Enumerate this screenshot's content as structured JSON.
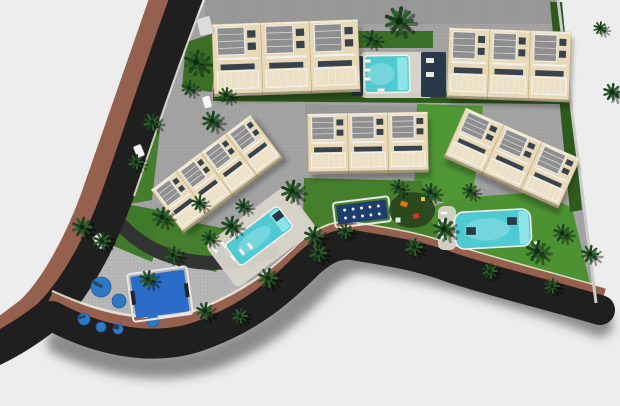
{
  "meta": {
    "title": "Aerial 3D masterplan render of a residential complex with townhouse blocks, pools, playgrounds and a curved perimeter road",
    "width": 620,
    "height": 406
  },
  "scene": {
    "colors": {
      "background": "#ededed",
      "pavement": "#a3a3a3",
      "pavement_dark": "#8c8c8c",
      "playground_pavement": "#b6b6b6",
      "road": "#1f1f1f",
      "driveway": "#2f2f2f",
      "sidewalk": "#96604f",
      "curb": "#e9e5d8",
      "road_shadow": "rgba(60,60,60,0.55)",
      "wall_cream": "#e8d9b9",
      "wall_edge": "#bfa97a",
      "roof_gray": "#8f8f8f",
      "roof_slat": "#dcdcdc",
      "parapet": "#f0ead8",
      "window_dark": "#39434d",
      "railing_white": "#f3f3f3",
      "water": "#4fc9d2",
      "water_light": "#9cebec",
      "deck_light": "#d8d5ca",
      "navy": "#2a3949",
      "court_navy": "#1e3c6e",
      "court_blue": "#2a6cc8",
      "pad_blue": "#2f79c2",
      "grass_bright": "#5fae3e",
      "palm_green": "#1c4220",
      "palm_green2": "#2a5c2a",
      "shadow": "rgba(0,0,0,0.3)",
      "boundary_wall": "#cbcbcb",
      "play_orange": "#e0761c",
      "play_red": "#cf3a2a",
      "play_yellow": "#e8c43c"
    },
    "site": {
      "path": "M205,0 L558,0 L596,303 C545,289 495,277 452,265 C415,254 385,247 358,241 C340,237 326,242 306,261 C278,288 248,312 208,328 C172,342 125,348 90,334 C70,326 56,310 60,292 C72,252 96,208 116,196 Z"
    },
    "paved": [
      {
        "name": "back-pavement-top",
        "path": "M205,0 L558,0 L558,24 L205,24 Z",
        "fill": "#8f8f8f",
        "opacity": 0.55
      },
      {
        "name": "back-pavement-mid",
        "path": "M305,104 L430,107 L430,117 L305,115 Z",
        "fill": "#909090",
        "opacity": 0.6
      },
      {
        "name": "terrace-right",
        "path": "M448,190 L552,186 L556,212 L452,216 Z",
        "fill": "#9e9e9e",
        "opacity": 1
      },
      {
        "name": "playground-pavement",
        "path": "M66,296 C80,250 96,234 118,231 L216,239 C238,243 250,257 248,276 C245,302 230,322 204,334 C175,347 126,346 97,337 C76,330 62,314 66,296 Z",
        "fill": "#b6b6b6",
        "opacity": 1
      }
    ],
    "grass": [
      {
        "name": "hedge-top-row",
        "path": "M213,89 L562,93 L562,104 L213,101 Z",
        "fill": "#2e5a1e"
      },
      {
        "name": "hedge-pool-garden",
        "path": "M357,31 L433,31 L433,48 L357,48 Z",
        "fill": "#3a7026"
      },
      {
        "name": "lawn-vertical-center",
        "path": "M417,104 L483,106 L472,206 L414,198 Z",
        "fill": "#4f9634"
      },
      {
        "name": "lawn-right",
        "path": "M428,208 L458,198 L540,192 L572,208 L594,300 L540,288 L468,266 L432,252 Z",
        "fill": "#4c9132"
      },
      {
        "name": "lawn-center",
        "path": "M304,178 L422,181 L436,236 L394,242 L336,246 L303,216 Z",
        "fill": "#457f2b"
      },
      {
        "name": "green-left-a",
        "path": "M128,121 L162,112 L152,200 L118,206 Z",
        "fill": "#447e2c"
      },
      {
        "name": "green-left-b",
        "path": "M116,202 L168,212 L152,262 L104,242 Z",
        "fill": "#3f7a2a"
      },
      {
        "name": "green-mid-left",
        "path": "M162,216 L232,230 L216,272 L148,256 Z",
        "fill": "#447e2c"
      },
      {
        "name": "green-top-left",
        "path": "M186,42 L218,32 L212,92 L182,88 Z",
        "fill": "#3c6f26"
      },
      {
        "name": "hedge-right-boundary",
        "path": "M550,2 L562,2 L582,210 L570,212 Z",
        "fill": "#2e5a1e"
      },
      {
        "name": "corner-grass-strip",
        "path": "M60,290 C64,310 76,322 94,331 L102,318 C86,310 75,299 72,287 Z",
        "fill": "#5fae3e"
      }
    ],
    "roads": {
      "sidewalk_upper": {
        "d": "M165,-14 C137,65 112,140 92,196 C76,240 52,285 28,308 C12,320 0,330 -14,338",
        "width": 22
      },
      "main_upper": {
        "d": "M190,-12 C162,62 138,138 118,194 C100,244 76,288 48,316 C30,330 12,342 -10,352",
        "width": 32
      },
      "curb_upper": {
        "d": "M206,-5 C180,60 155,135 134,196",
        "width": 2
      },
      "shadow_lower": {
        "d": "M60,342 C120,370 180,372 225,352 C270,332 298,306 326,276 C344,260 358,256 374,260 C408,266 438,272 470,282 C515,296 556,306 600,324",
        "width": 26
      },
      "curb_lower": {
        "d": "M52,291 C110,318 162,324 202,308 C246,290 274,268 302,241 C322,224 339,220 356,223 C393,229 420,233 452,245 C498,259 548,272 604,288",
        "width": 2.5
      },
      "sidewalk_lower": {
        "d": "M50,298 C108,326 160,332 202,316 C248,298 276,276 304,248 C324,231 340,227 356,230 C393,236 420,240 452,252 C498,266 548,279 604,295",
        "width": 13
      },
      "main_lower": {
        "d": "M52,316 C105,344 160,352 205,334 C252,316 280,292 308,264 C328,246 342,242 358,246 C395,252 420,256 452,268 C495,282 545,294 600,310",
        "width": 30
      },
      "driveway": {
        "d": "M106,206 C130,242 162,258 198,262 C226,265 250,260 272,251",
        "width": 14
      }
    },
    "boundary": {
      "x1": 558,
      "y1": 0,
      "x2": 596,
      "y2": 303
    },
    "buildings": [
      {
        "name": "building-block-1",
        "cx": 286,
        "cy": 58,
        "w": 146,
        "h": 72,
        "rot": -2,
        "units": 3
      },
      {
        "name": "building-block-2",
        "cx": 509,
        "cy": 65,
        "w": 122,
        "h": 70,
        "rot": 2,
        "units": 3
      },
      {
        "name": "building-block-3",
        "cx": 217,
        "cy": 174,
        "w": 124,
        "h": 54,
        "rot": -37,
        "units": 4
      },
      {
        "name": "building-block-4",
        "cx": 368,
        "cy": 143,
        "w": 120,
        "h": 60,
        "rot": -1,
        "units": 3
      },
      {
        "name": "building-block-5",
        "cx": 512,
        "cy": 158,
        "w": 125,
        "h": 54,
        "rot": 24,
        "units": 3
      }
    ],
    "pool_decks": [
      {
        "name": "deck-top-pool",
        "x": 360,
        "y": 52,
        "w": 74,
        "h": 46,
        "rot": 0,
        "fill": "#d9d6cc"
      },
      {
        "name": "deck-central-pool",
        "x": -50,
        "y": -27,
        "w": 100,
        "h": 54,
        "cx": 261,
        "cy": 237,
        "rot": -37,
        "fill": "#d8d5ca"
      },
      {
        "name": "deck-right-pool",
        "x": 438,
        "y": 206,
        "w": 18,
        "h": 44,
        "rot": 0,
        "fill": "#d6d3c8"
      }
    ],
    "pools": [
      {
        "name": "pool-top",
        "cx": 387,
        "cy": 74,
        "w": 45,
        "h": 37,
        "rot": -1,
        "rx": 3
      },
      {
        "name": "pool-central",
        "cx": 259,
        "cy": 236,
        "w": 66,
        "h": 27,
        "rot": -37,
        "rx": 4
      },
      {
        "name": "pool-right",
        "cx": 493,
        "cy": 229,
        "w": 76,
        "h": 37,
        "rot": -3,
        "rx": 9
      }
    ],
    "navy_structures": [
      {
        "name": "pool-house-left",
        "x": 352,
        "y": 56,
        "w": 11,
        "h": 40,
        "rot": 0
      },
      {
        "name": "pool-house-right",
        "x": 421,
        "y": 52,
        "w": 25,
        "h": 45,
        "rot": 0
      }
    ],
    "courts": [
      {
        "name": "petanque-dots-court",
        "cx": 362,
        "cy": 212,
        "w": 50,
        "h": 19,
        "rot": -7,
        "fill": "#1e3c6e",
        "dots_x": 5,
        "dots_y": 2
      },
      {
        "name": "multisport-court",
        "cx": 160,
        "cy": 294,
        "w": 54,
        "h": 42,
        "rot": -8,
        "fill": "#2a6cc8",
        "dots_x": 0,
        "dots_y": 0
      }
    ],
    "playground_pads": [
      {
        "x": 101,
        "y": 287,
        "r": 10
      },
      {
        "x": 119,
        "y": 301,
        "r": 7
      },
      {
        "x": 84,
        "y": 319,
        "r": 6
      },
      {
        "x": 101,
        "y": 327,
        "r": 5
      },
      {
        "x": 118,
        "y": 329,
        "r": 5
      },
      {
        "x": 153,
        "y": 321,
        "r": 6
      }
    ],
    "play_items": [
      {
        "x": 97,
        "y": 284,
        "w": 12,
        "h": 3.5,
        "rot": 28,
        "fill": "#23476e"
      },
      {
        "x": 82,
        "y": 317,
        "w": 7,
        "h": 3,
        "rot": -15,
        "fill": "#23476e"
      },
      {
        "x": 116,
        "y": 327,
        "w": 6,
        "h": 4,
        "rot": 10,
        "fill": "#1d3c5e"
      },
      {
        "x": 404,
        "y": 204,
        "w": 7,
        "h": 5,
        "rot": 20,
        "fill": "#e0761c"
      },
      {
        "x": 416,
        "y": 216,
        "w": 6,
        "h": 5,
        "rot": -10,
        "fill": "#cf3a2a"
      },
      {
        "x": 423,
        "y": 199,
        "w": 4,
        "h": 4,
        "rot": 0,
        "fill": "#e8c43c"
      },
      {
        "x": 398,
        "y": 220,
        "w": 5,
        "h": 5,
        "rot": 0,
        "fill": "#e6e6e6"
      }
    ],
    "play_area_patch": {
      "cx": 412,
      "cy": 210,
      "rx": 23,
      "ry": 18,
      "fill": "#27451d"
    },
    "loungers": [
      [
        367,
        61,
        0
      ],
      [
        367,
        70,
        0
      ],
      [
        367,
        79,
        0
      ],
      [
        381,
        90,
        0
      ],
      [
        215,
        250,
        53
      ],
      [
        224,
        245,
        53
      ],
      [
        233,
        258,
        53
      ],
      [
        242,
        252,
        53
      ],
      [
        250,
        246,
        53
      ],
      [
        444,
        213,
        0
      ],
      [
        444,
        221,
        0
      ],
      [
        444,
        229,
        0
      ],
      [
        444,
        237,
        0
      ],
      [
        536,
        243,
        -3
      ],
      [
        536,
        249,
        -3
      ]
    ],
    "daybeds": [
      [
        278,
        216,
        -37
      ],
      [
        471,
        231,
        0
      ],
      [
        512,
        221,
        0
      ]
    ],
    "cars": [
      {
        "x": 139,
        "y": 151,
        "w": 8,
        "h": 12,
        "rot": -22,
        "fill": "#f4f4f4"
      },
      {
        "x": 100,
        "y": 241,
        "w": 9,
        "h": 14,
        "rot": -35,
        "fill": "#eaeaea"
      },
      {
        "x": 207,
        "y": 102,
        "w": 8,
        "h": 12,
        "rot": -15,
        "fill": "#f6f6f6"
      },
      {
        "x": 205,
        "y": 26,
        "w": 14,
        "h": 18,
        "rot": -15,
        "fill": "#dcdcdc"
      }
    ],
    "palms": [
      [
        196,
        62,
        11
      ],
      [
        212,
        121,
        9
      ],
      [
        189,
        88,
        7
      ],
      [
        226,
        95,
        7
      ],
      [
        399,
        21,
        13
      ],
      [
        371,
        39,
        8
      ],
      [
        82,
        227,
        9
      ],
      [
        102,
        241,
        8
      ],
      [
        148,
        279,
        8
      ],
      [
        173,
        255,
        8
      ],
      [
        152,
        122,
        8
      ],
      [
        136,
        162,
        7
      ],
      [
        162,
        217,
        9
      ],
      [
        199,
        203,
        7
      ],
      [
        231,
        226,
        9
      ],
      [
        209,
        238,
        7
      ],
      [
        292,
        191,
        10
      ],
      [
        314,
        236,
        9
      ],
      [
        268,
        278,
        9
      ],
      [
        243,
        206,
        7
      ],
      [
        345,
        231,
        7
      ],
      [
        398,
        187,
        7
      ],
      [
        430,
        192,
        8
      ],
      [
        444,
        229,
        10
      ],
      [
        414,
        247,
        8
      ],
      [
        537,
        251,
        10
      ],
      [
        562,
        233,
        8
      ],
      [
        590,
        254,
        8
      ],
      [
        470,
        191,
        7
      ],
      [
        612,
        92,
        8
      ],
      [
        600,
        28,
        6
      ],
      [
        205,
        311,
        8
      ],
      [
        318,
        253,
        8
      ],
      [
        490,
        271,
        7
      ],
      [
        552,
        286,
        7
      ],
      [
        240,
        316,
        7
      ]
    ]
  }
}
